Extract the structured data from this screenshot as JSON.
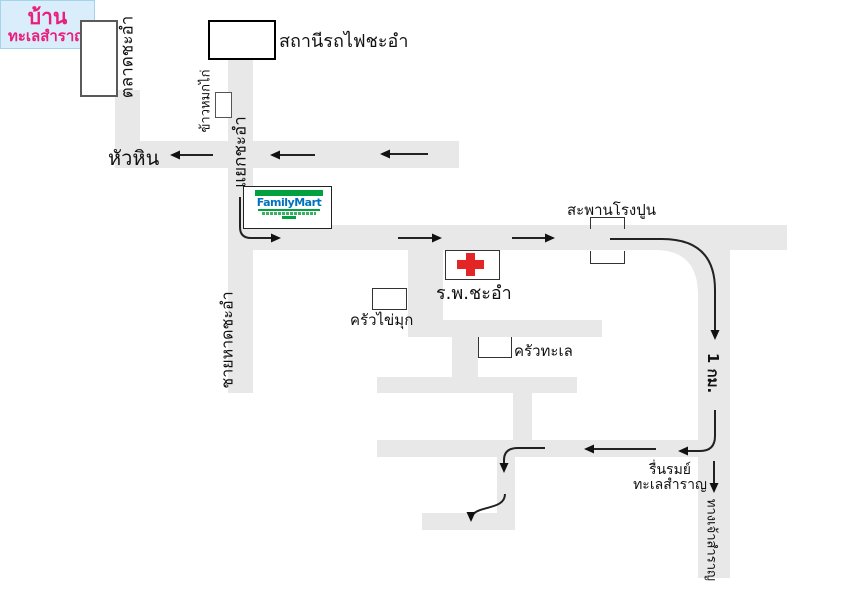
{
  "colors": {
    "road": "#e8e8e8",
    "cross_red": "#e42525",
    "familymart_green": "#00a13e",
    "familymart_blue": "#0072bc",
    "destination_fill": "#d9eefa",
    "destination_border": "#a5d3e8",
    "destination_text": "#e91e7e"
  },
  "landmarks": {
    "market": "ตลาดชะอำ",
    "train_station": "สถานีรถไฟชะอำ",
    "chicken_rice_stall": "ข้าวหมกไก่",
    "familymart": "FamilyMart",
    "cement_bridge": "สะพานโรงปูน",
    "hospital": "ร.พ.ชะอำ",
    "pearl_kitchen": "ครัวไข่มุก",
    "sea_kitchen": "ครัวทะเล",
    "resort_line1": "รื่นรมย์",
    "resort_line2": "ทะเลสำราญ"
  },
  "roads": {
    "hua_hin": "หัวหิน",
    "cha_am_junction": "แยกชะอำ",
    "cha_am_beach": "ชายหาดชะอำ",
    "distance_1km": "1 กม.",
    "jao_samran_way": "ทางเจ้าสำราญ"
  },
  "destination": {
    "line1": "บ้าน",
    "line2": "ทะเลสำราญ"
  }
}
